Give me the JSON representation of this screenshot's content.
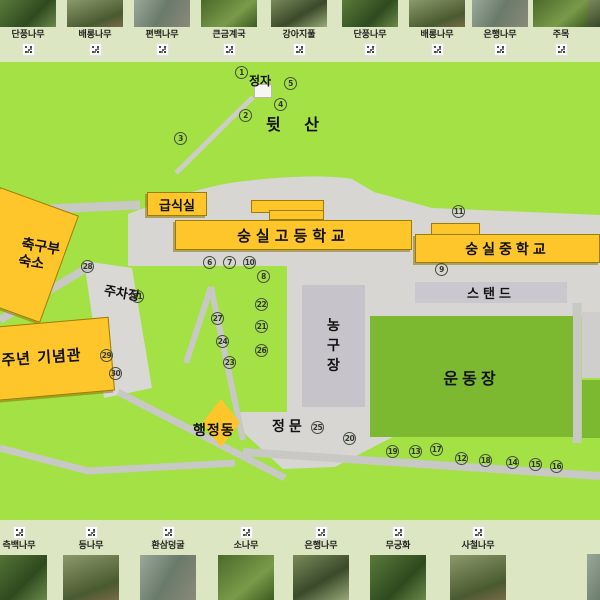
{
  "map": {
    "pavilion_label": "정자",
    "hill_label": "뒷 산",
    "cafeteria_label": "급식실",
    "highschool_label": "숭실고등학교",
    "middleschool_label": "숭실중학교",
    "stand_label": "스탠드",
    "basketball_label": "농구장",
    "field_label": "운동장",
    "soccer_dorm_label_line1": "축구부",
    "soccer_dorm_label_line2": "숙소",
    "parking_label": "주차장",
    "memorial_label": "0주년 기념관",
    "admin_label": "행정동",
    "gate_label": "정문",
    "colors": {
      "map_green": "#a3e145",
      "field_green": "#7cb931",
      "building_yellow": "#ffc62b",
      "plaza_gray": "#d7d6d3",
      "court_gray": "#c6c3cb",
      "stand_gray": "#cac8ce"
    },
    "markers": [
      {
        "n": "1",
        "x": 242,
        "y": 73
      },
      {
        "n": "2",
        "x": 246,
        "y": 116
      },
      {
        "n": "3",
        "x": 181,
        "y": 139
      },
      {
        "n": "4",
        "x": 281,
        "y": 105
      },
      {
        "n": "5",
        "x": 291,
        "y": 84
      },
      {
        "n": "6",
        "x": 210,
        "y": 263
      },
      {
        "n": "7",
        "x": 230,
        "y": 263
      },
      {
        "n": "8",
        "x": 264,
        "y": 277
      },
      {
        "n": "9",
        "x": 442,
        "y": 270
      },
      {
        "n": "10",
        "x": 250,
        "y": 263
      },
      {
        "n": "11",
        "x": 459,
        "y": 212
      },
      {
        "n": "12",
        "x": 462,
        "y": 459
      },
      {
        "n": "13",
        "x": 416,
        "y": 452
      },
      {
        "n": "14",
        "x": 513,
        "y": 463
      },
      {
        "n": "15",
        "x": 536,
        "y": 465
      },
      {
        "n": "16",
        "x": 557,
        "y": 467
      },
      {
        "n": "17",
        "x": 437,
        "y": 450
      },
      {
        "n": "18",
        "x": 486,
        "y": 461
      },
      {
        "n": "19",
        "x": 393,
        "y": 452
      },
      {
        "n": "20",
        "x": 350,
        "y": 439
      },
      {
        "n": "21",
        "x": 262,
        "y": 327
      },
      {
        "n": "22",
        "x": 262,
        "y": 305
      },
      {
        "n": "23",
        "x": 230,
        "y": 363
      },
      {
        "n": "24",
        "x": 223,
        "y": 342
      },
      {
        "n": "25",
        "x": 318,
        "y": 428
      },
      {
        "n": "26",
        "x": 262,
        "y": 351
      },
      {
        "n": "27",
        "x": 218,
        "y": 319
      },
      {
        "n": "28",
        "x": 88,
        "y": 267
      },
      {
        "n": "29",
        "x": 107,
        "y": 356
      },
      {
        "n": "30",
        "x": 116,
        "y": 374
      },
      {
        "n": "31",
        "x": 138,
        "y": 297
      }
    ]
  },
  "top_strip": {
    "items": [
      {
        "label": "단풍나무",
        "x": 28
      },
      {
        "label": "배롱나무",
        "x": 95
      },
      {
        "label": "편백나무",
        "x": 162
      },
      {
        "label": "큰금계국",
        "x": 229
      },
      {
        "label": "강아지풀",
        "x": 299
      },
      {
        "label": "단풍나무",
        "x": 370
      },
      {
        "label": "배롱나무",
        "x": 437
      },
      {
        "label": "은행나무",
        "x": 500
      },
      {
        "label": "주목",
        "x": 561
      },
      {
        "label": "",
        "x": 616,
        "partial": true
      }
    ]
  },
  "bottom_strip": {
    "items": [
      {
        "label": "측백나무",
        "x": 19
      },
      {
        "label": "등나무",
        "x": 91
      },
      {
        "label": "환삼덩굴",
        "x": 168
      },
      {
        "label": "소나무",
        "x": 246
      },
      {
        "label": "은행나무",
        "x": 321
      },
      {
        "label": "무궁화",
        "x": 398
      },
      {
        "label": "사철나무",
        "x": 478
      },
      {
        "label": "",
        "x": 615,
        "partial": true
      }
    ]
  }
}
